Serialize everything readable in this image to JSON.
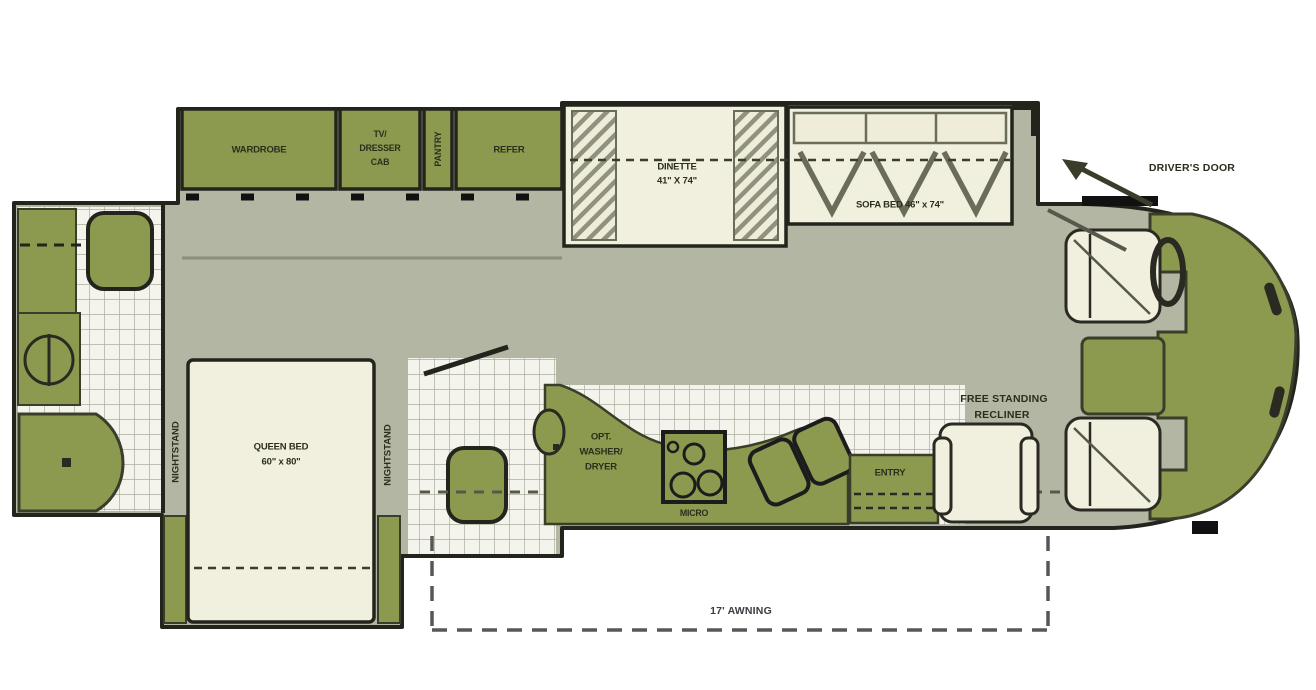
{
  "title": "Motorhome floor plan diagram",
  "colors": {
    "furniture_olive": "#8C9A50",
    "floor_gray_green": "#B2B6A2",
    "upholstery_cream": "#F1EFDE",
    "tile_white": "#F5F4EC",
    "tile_grid": "#A9AE9C",
    "outline_dark": "#23241C",
    "label_text": "#2C2E1D"
  },
  "labels": {
    "wardrobe": "WARDROBE",
    "tv_dresser_cab": [
      "TV/",
      "DRESSER",
      "CAB"
    ],
    "pantry": "PANTRY",
    "refer": "REFER",
    "dinette": [
      "DINETTE",
      "41\" X 74\""
    ],
    "sofa_bed": "SOFA BED 46\" x 74\"",
    "drivers_door": "DRIVER'S DOOR",
    "queen_bed": [
      "QUEEN BED",
      "60\" x 80\""
    ],
    "nightstand_left": "NIGHTSTAND",
    "nightstand_right": "NIGHTSTAND",
    "opt_washer_dryer": [
      "OPT.",
      "WASHER/",
      "DRYER"
    ],
    "micro": "MICRO",
    "entry": "ENTRY",
    "free_standing_recliner": [
      "FREE STANDING",
      "RECLINER"
    ],
    "awning": "17' AWNING"
  }
}
